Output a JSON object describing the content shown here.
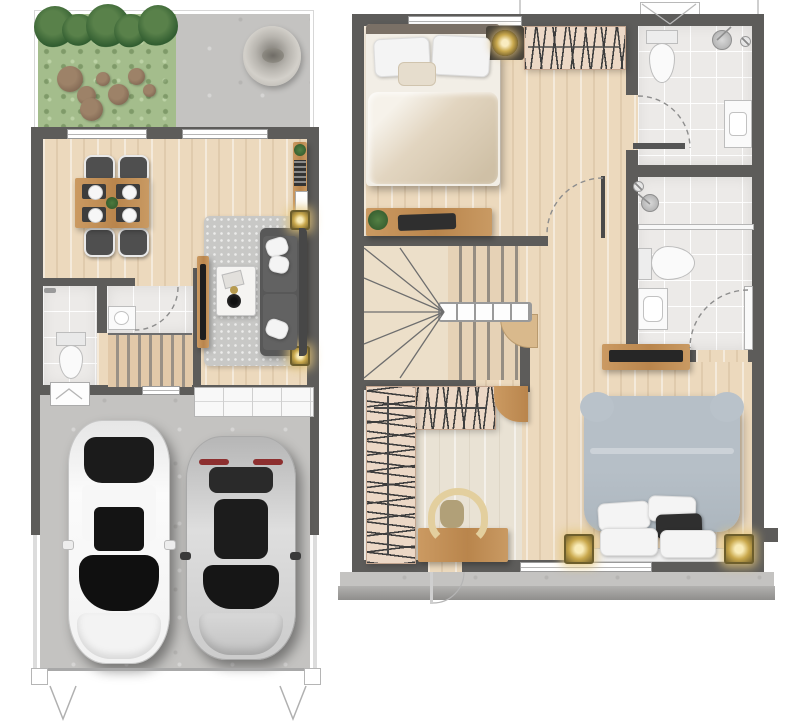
{
  "title": "Townhouse floor plans - ground floor and upper floor",
  "colors": {
    "wall": "#5d5c5a",
    "wood": "#ecd9bd",
    "wood_light": "#e9e2d4",
    "concrete": "#c4c3c1",
    "grass": "#a4bd8c",
    "tile": "#eceae8",
    "rack": "#ecd8c6",
    "wood_furniture": "#c08f58",
    "sofa_gray": "#585858",
    "rug_gray": "#c8c8c6",
    "bed2_duvet": "#b6bfc7",
    "gold": "#c9a84c",
    "fixture_white": "#fafafa",
    "line_gray": "#9a9a9a"
  },
  "plans": [
    {
      "id": "first-floor",
      "rooms": [
        "garden",
        "patio",
        "dining-living-room",
        "powder-room",
        "stairs",
        "garage",
        "driveway"
      ],
      "furniture": [
        "shrubs",
        "stepping-stones",
        "stone-ornament",
        "dining-table",
        "dining-chairs",
        "place-settings",
        "wall-shelf",
        "rug",
        "sofa",
        "coffee-table",
        "tv-console",
        "toilet",
        "washbasin",
        "storage-cabinet",
        "garage-counter",
        "white-sedan-car",
        "silver-suv-car",
        "ceiling-downlights"
      ],
      "counts": {
        "dining_chairs": 4,
        "cars": 2,
        "windows_top_wall": 2,
        "downlights": 2
      }
    },
    {
      "id": "second-floor",
      "rooms": [
        "bedroom-1",
        "bathroom-1",
        "bathroom-2",
        "hallway",
        "stairs",
        "walk-in-closet",
        "master-bedroom",
        "balcony"
      ],
      "furniture": [
        "double-bed-beige",
        "pillows",
        "nightstand",
        "round-ceiling-lamp",
        "clothes-rack",
        "desk-with-laptop",
        "plant",
        "toilet",
        "shower-head",
        "vanity-sink",
        "glass-partition",
        "door-leaves",
        "media-shelf",
        "tv",
        "master-bed-gray-duvet",
        "gold-wall-lamps",
        "l-shaped-wardrobe",
        "corner-counter",
        "closet-desk",
        "closet-chair",
        "handrail",
        "winder-stairs",
        "ac-unit"
      ],
      "counts": {
        "bathrooms": 2,
        "beds": 2,
        "gold_lamps": 2
      }
    }
  ]
}
